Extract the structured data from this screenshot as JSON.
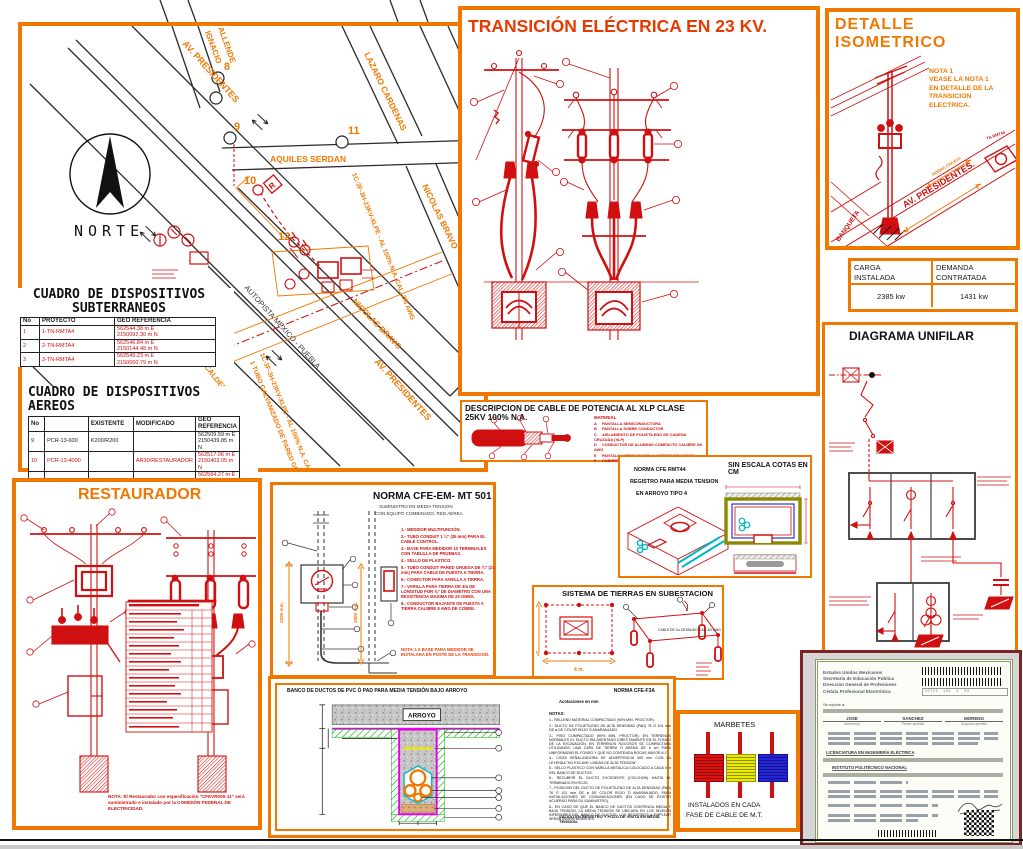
{
  "colors": {
    "panel_orange": "#F07800",
    "drawing_red": "#D01010",
    "title_red": "#E83A00",
    "cad_black": "#1A1A1A",
    "cyan": "#00B8C8",
    "magenta": "#E800E8",
    "green": "#00B000",
    "yellow": "#E8E800"
  },
  "map": {
    "north_label": "NORTE",
    "streets": {
      "av_presidentes_top": "AV. PRESIDENTES",
      "ignacio_allende_1": "IGNACIO",
      "ignacio_allende_2": "ALLENDE",
      "lazaro_cardenas": "LAZARO CARDENAS",
      "aquiles_serdan": "AQUILES SERDAN",
      "nicolas_bravo": "NICOLAS BRAVO",
      "nicolas_bravo_lower": "NICOLAS BRAVO",
      "autopista": "AUTOPISTA MEXICO - PUEBLA",
      "av_presidentes_lower": "AV. PRESIDENTES"
    },
    "nodes": {
      "n8": "8",
      "n9": "9",
      "n10": "10",
      "n11": "11",
      "n12": "12"
    },
    "station": "ESTACION LA CALDERA",
    "route_label_right": "1C-3F-3H-23KV-XLPE - AL 100% N.A. CAL. 3/0 AWG",
    "route_label_left": "1C-3F-3H-23KV-XLPE - AL 100% N.A. CAL. 3/0 AWG 1H-Cu CAL. 1/0 AWG",
    "route_label_left2": "1 TUBO GALVANIZADO DE PARED GRUESA 4\"",
    "restaurador_tag": "R"
  },
  "cuadro_sub": {
    "title": "CUADRO DE DISPOSITIVOS",
    "subtitle": "SUBTERRANEOS",
    "headers": [
      "No",
      "PROYECTO",
      "GEO REFERENCIA"
    ],
    "rows": [
      [
        "1",
        "1-TN-RMTA4",
        "562544.38 m E\n2150092.30 m N"
      ],
      [
        "2",
        "2-TN-RMTA4",
        "562546.84 m E\n2150144.48 m N"
      ],
      [
        "3",
        "3-TN-RMTA4",
        "562549.23 m E\n2150060.79 m N"
      ]
    ]
  },
  "cuadro_aer": {
    "title": "CUADRO DE DISPOSITIVOS",
    "subtitle": "AEREOS",
    "headers": [
      "No",
      "",
      "EXISTENTE",
      "MODIFICADO",
      "GEO REFERENCIA"
    ],
    "rows": [
      [
        "9",
        "PCR-13-600",
        "K200/R200",
        "",
        "562509.59 m E\n2150439.85 m N"
      ],
      [
        "10",
        "PCR-13-4000",
        "",
        "AR30/RESTAURADOR",
        "562517.06 m E\n2150403.05 m N"
      ],
      [
        "11",
        "PCR-13-600",
        "",
        "K200/TAO",
        "562584.27 m E\n2150435.66 m N"
      ]
    ]
  },
  "transicion": {
    "title": "TRANSICIÓN ELÉCTRICA EN 23 KV.",
    "material": {
      "title_1": "LISTA DE MATERIAL DE",
      "title_2": "TRANSICION",
      "col_qty": "CANTIDAD",
      "col_unit": "UNIDAD",
      "rows": [
        [
          "1.- EL TUBO DE LA TRANSICION DEBE DE INSTALARSE EN EL LADO OPUESTO A LA VIALIDAD VEHICULAR.",
          "",
          ""
        ],
        [
          "2.- CONECTOR TIPO ESTRIBO.",
          "3",
          "PZA"
        ],
        [
          "3.- CONECTOR TIPO PERICO.",
          "3",
          "PZA"
        ],
        [
          "4.- CABLE ACSR CALIBRE 2 AWG.",
          "1",
          "KG"
        ],
        [
          "5.- CUCHILLA MONOPOLAR 600 AMP.",
          "3",
          "PZA"
        ],
        [
          "6.- AISLADOR 23HB/LAPO.",
          "3",
          "PZA"
        ],
        [
          "7.- TERMINAL CONTRACTIL EN FRIO 25 KV DE USO EXTERIOR PARA XLP.",
          "3",
          "PZA"
        ],
        [
          "8.- CABLE DE POTENCIA TIPO XLP DE ALUMINIO CAL. 3/0 DE 100% DE AISLAMIENTO, 25 KV.",
          "400",
          "M"
        ],
        [
          "9.- GUIA TERMOCONTRACTIL 4\" - 3 PIERNAS.",
          "1",
          "PZA"
        ],
        [
          "10.- TUBO PAD COLOR NEGRO CON PROTECCIÓN P/RAYOS UV.",
          "4",
          "M"
        ],
        [
          "11.- CONECTOR BAJANTE A TIERRA.",
          "1",
          "PZA"
        ],
        [
          "12.- FLEJE DE ACERO INOX. DE 5/8\" DE ESPESOR.",
          "1",
          "M"
        ],
        [
          "13.- CABLE DE COBRE DESNUDO CALIBRE 1/0.",
          "9",
          "KG"
        ],
        [
          "14.- SOLDADURA TIPO CADWELD.",
          "1",
          "PZA"
        ],
        [
          "15.- VARILLA COOPERWELD. 5/8\"",
          "1",
          "PZA"
        ],
        [
          "16.- PERNO DE ANCLA.",
          "4",
          "PZA"
        ],
        [
          "17.- CRUCETA TIPO PR300.",
          "4",
          "PZA"
        ],
        [
          "18.- CRUCETA TIPO PT200.",
          "4",
          "PZA"
        ],
        [
          "19.- ABRAZADERA TIPO UL.",
          "2",
          "PZA"
        ],
        [
          "20.- EQUIPO COMPACTO DE MEDICION.",
          "1",
          "PZA"
        ],
        [
          "21.- ABRAZADERA TIPO VIGO.",
          "1",
          "PZA"
        ],
        [
          "22.- POSTE DE CONCRETO REFORZADO 12-750.",
          "1",
          "PZA"
        ],
        [
          "23.- CONSIDERA CANAL 40 CM.",
          "4",
          "PZA"
        ],
        [
          "24.- MENSULA 25 CM.",
          "6",
          "PZA"
        ],
        [
          "25.- AISLADOR DE MEDIA LUNA DE NEOPRENO.",
          "18",
          "PZA"
        ],
        [
          "26.- APARTARRAYO ACZN TD 15 KV POLIMERICO NNE POLE.",
          "3",
          "PZA"
        ]
      ]
    }
  },
  "detalle": {
    "title": "DETALLE ISOMETRICO",
    "nota": "NOTA 1\nVEASE LA NOTA 1\nEN DETALLE DE LA\nTRANSICION\nELECTRICA.",
    "street": "AV. PRESIDENTES.",
    "banqueta": "BANQUETA",
    "norma": "NORMA CFE-E7A",
    "registro": "TN RMT44"
  },
  "carga": {
    "h1": "CARGA\nINSTALADA",
    "h2": "DEMANDA\nCONTRATADA",
    "v1": "2385 kw",
    "v2": "1431 kw"
  },
  "unifilar": {
    "title": "DIAGRAMA UNIFILAR"
  },
  "restaurador": {
    "title": "RESTAURADOR",
    "note": "NOTA: El Restaurador con especificación \"CFEVR000-11\" será suministrado e instalado por la COMISIÓN FEDERAL DE ELECTRICIDAD."
  },
  "norma501": {
    "title": "NORMA CFE-EM- MT 501",
    "sub1": "SUMINISTRO EN MEDIA TENSION",
    "sub2": "CON EQUIPO COMBINADO, RED AEREA",
    "dim_left": "1800 mm.",
    "dim_right": "1800 mm.",
    "notes": [
      "1.- MEDIDOR MULTIFUNCIÓN.",
      "2.- TUBO CONDUIT 1 ¼\" (35 mm) PARA EL CABLE CONTROL.",
      "3.- BASE PARA MEDIDOR 13 TERMINALES CON TABLILLA DE PRUEBAS.",
      "4.- SELLO DE PLASTICO.",
      "5.- TUBO CONDUIT PARED GRUESA DE ¾\" (21 mm) PARA CABLE DE PUESTA A TIERRA.",
      "6.- CONECTOR PARA VARILLA A TIERRA.",
      "7.- VARILLA PARA TIERRA DE 3m DE LONGITUD POR ⅝\" DE DIAMETRO CON UNA RESISTENCIA MAXIMA DE 25 OHMS.",
      "8.- CONDUCTOR BAJANTE DE PUESTA A TIERRA CALIBRE 8 AWG DE COBRE."
    ],
    "nota": "NOTA: LA BASE PARA MEDIDOR SE INSTALARA EN POSTE DE LA TRANSICION."
  },
  "cable": {
    "title": "DESCRIPCION DE CABLE DE POTENCIA AL  XLP CLASE 25KV 100% N.A.",
    "material_header": "MATERIAL",
    "items": [
      [
        "A",
        "PANTALLA SEMICONDUCTORA"
      ],
      [
        "B",
        "PANTALLA SOBRE CONDUCTOR"
      ],
      [
        "C",
        "AISLAMIENTO DE POLIETILENO DE CADENA CRUZADA (XLP)"
      ],
      [
        "D",
        "CONDUCTOR DE ALUMINIO COMPACTO CALIBRE 3/0 AWG"
      ],
      [
        "E",
        "PANTALLA METÁLICA DE ALAMBRES DE COBRE"
      ],
      [
        "F",
        "CUBIERTA DE PVC."
      ]
    ]
  },
  "registro": {
    "line1": "NORMA  CFE RMT44",
    "line2": "REGISTRO PARA MEDIA TENSION",
    "line3": "EN ARROYO TIPO  4",
    "scale": "SIN ESCALA COTAS EN CM"
  },
  "tierras": {
    "title": "SISTEMA DE TIERRAS EN SUBESTACION",
    "dim": "4 m.",
    "cable_label": "CABLE DE Cu DESNUDO\nCAL. 4/0 AWG"
  },
  "banco": {
    "title": "BANCO DE DUCTOS DE PVC Ó PAD PARA MEDIA TENSIÓN BAJO ARROYO",
    "norma": "NORMA CFE-F3A",
    "arroyo": "ARROYO",
    "acot": "Acotaciones en mm",
    "notas_header": "NOTAS:",
    "notes": [
      "1.- RELLENO MATERIAL COMPACTADO (90% MIN. PROCTOR).",
      "2.- DUCTO DE POLIETILENO DE ALTA DENSIDAD (PAD) 76 Ó 101 mm DE ø DE COLOR ROJO Ó ANARANJADO.",
      "3.- PISO COMPACTADO (90% MIN. PROCTOR). EN TERRENOS NORMALES EL DUCTO IRA ASENTADO DIRECTAMENTE EN EL FONDO DE LA EXCAVACIÓN. EN TERRENOS ROCOSOS SE COMPACTARA UTILIZANDO UNA CAPA DE TIERRA Ó ARENA DE 5 cm PARA UNIFORMIZAR EL FONDO Y QUE NO CONTENGA ROCAS MAYOR A 1\".",
      "4.- CINTA SEÑALIZADORA DE ADVERTENCIA 300 mm CON LA LEYENDA \"NO EXCAVE: LINEAS DE ALTA TENSION\".",
      "5.- SELLO PLASTICO CON VARILLA METALICA COLOCADO A CADA 5 m DEL BANCO DE DUCTOS.",
      "6.- RECUBRIR EL DUCTO EXCEDENTE (COLCHON) HASTA EL TERMINADO EN ROJO.",
      "7.- POSICION DEL DUCTO DE POLIETILENO DE ALTA DENSIDAD (PAD) 76 Ó 101 mm DE ø DE COLOR ROJO Ó ANARANJADO, PARA INSTALACIONES DE COMUNICACIONES (EN CASO DE EXISTIR ACUERDO PARA SU SUMINISTRO).",
      "8.- EN CASO DE QUE EL BANCO DE DUCTOS CONTENGA MEDIA Y BAJA TENSIÓN, LA MEDIA TENSIÓN SE UBICARA EN LOS NIVELES INFERIORES DEL BANCO DE DUCTOS. LOS REGISTROS A EMPLEAR SERAN INDEPENDIENTES."
    ],
    "footer": "VÁLIDO EN REGISTRO Y POZO DE VISITA EN MEDIA TENSIÓN."
  },
  "marbetes": {
    "title": "MARBETES",
    "caption1": "INSTALADOS EN CADA",
    "caption2": "FASE DE CABLE DE M.T."
  },
  "cert": {
    "header": [
      "Estados Unidos Mexicanos",
      "Secretaría de Educación Pública",
      "Dirección General de Profesiones",
      "Cédula Profesional Electrónica"
    ],
    "expide": "Se expide a:",
    "name_headers": [
      "Nombre(s)",
      "Primer apellido",
      "Segundo apellido"
    ],
    "names": [
      "JOSE",
      "SANCHEZ",
      "MORENO"
    ],
    "carrera": "LICENCIATURA EN INGENIERÍA ELÉCTRICA",
    "institucion": "INSTITUTO POLITÉCNICO NACIONAL"
  }
}
